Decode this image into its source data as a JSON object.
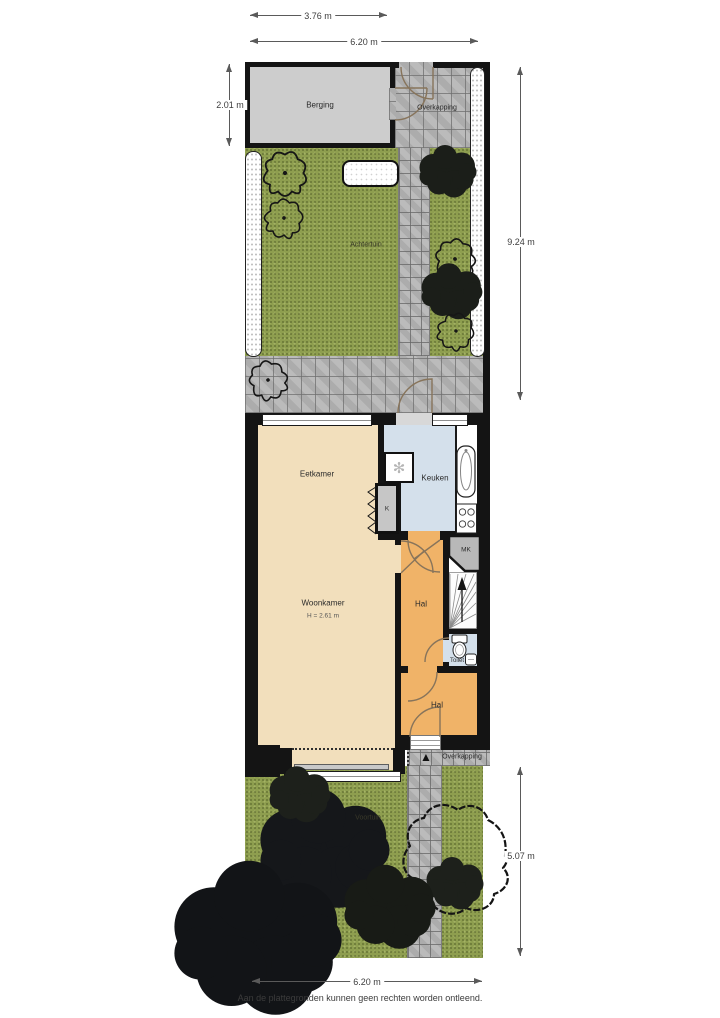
{
  "plan": {
    "footer": "Aan de plattegronden kunnen geen rechten worden ontleend."
  },
  "dimensions": {
    "berging_width": "3.76 m",
    "plot_width_top": "6.20 m",
    "berging_height": "2.01 m",
    "achtertuin_height": "9.24 m",
    "voortuin_height": "5.07 m",
    "plot_width_bottom": "6.20 m"
  },
  "rooms": {
    "berging": "Berging",
    "overkapping_top": "Overkapping",
    "achtertuin": "Achtertuin",
    "eetkamer": "Eetkamer",
    "keuken": "Keuken",
    "closet": "K",
    "woonkamer": "Woonkamer",
    "woonkamer_ceiling": "H = 2.61 m",
    "hal_upper": "Hal",
    "meterkast": "MK",
    "toilet": "Toilet",
    "hal_lower": "Hal",
    "overkapping_bottom": "Overkapping",
    "voortuin": "Voortuin"
  },
  "icons": {
    "fan": "✻",
    "north_arrow": "▲"
  },
  "colors": {
    "wall": "#141414",
    "living_floor": "#f2dfbc",
    "kitchen_floor": "#d4e0eb",
    "hall_floor": "#f0b368",
    "grass": "#8e9e4f",
    "paving": "#b5b5b5",
    "storage_floor": "#cdcdcd"
  }
}
